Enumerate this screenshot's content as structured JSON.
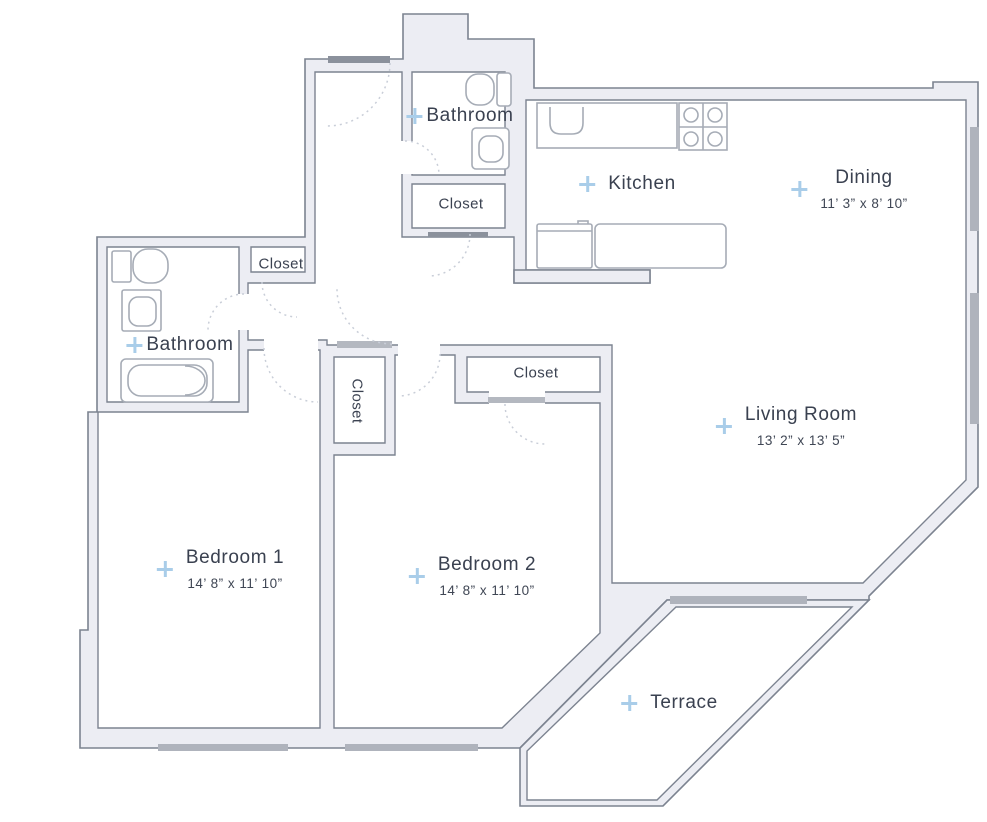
{
  "title": "Apartment floor plan",
  "colors": {
    "wall_fill": "#ECEDF3",
    "wall_line": "#7C8390",
    "fixture": "#A6ACB6",
    "window": "#AFB3BC",
    "door": "#8B919C",
    "door_light": "#B4B8C0",
    "arc": "#C9CED8",
    "text": "#3A4150",
    "accent": "#A9CDE9",
    "bg": "#FFFFFF"
  },
  "rooms": {
    "kitchen": {
      "label": "Kitchen"
    },
    "dining": {
      "label": "Dining",
      "dims": "11’ 3” x 8’ 10”"
    },
    "living_room": {
      "label": "Living Room",
      "dims": "13’ 2” x 13’ 5”"
    },
    "bedroom_1": {
      "label": "Bedroom 1",
      "dims": "14’ 8” x 11’ 10”"
    },
    "bedroom_2": {
      "label": "Bedroom 2",
      "dims": "14’ 8” x 11’ 10”"
    },
    "terrace": {
      "label": "Terrace"
    },
    "bathroom_top": {
      "label": "Bathroom"
    },
    "bathroom_left": {
      "label": "Bathroom"
    },
    "closet_hall_top": {
      "label": "Closet"
    },
    "closet_hall_left": {
      "label": "Closet"
    },
    "closet_bedrooms": {
      "label": "Closet"
    },
    "closet_bedroom_2": {
      "label": "Closet"
    }
  }
}
